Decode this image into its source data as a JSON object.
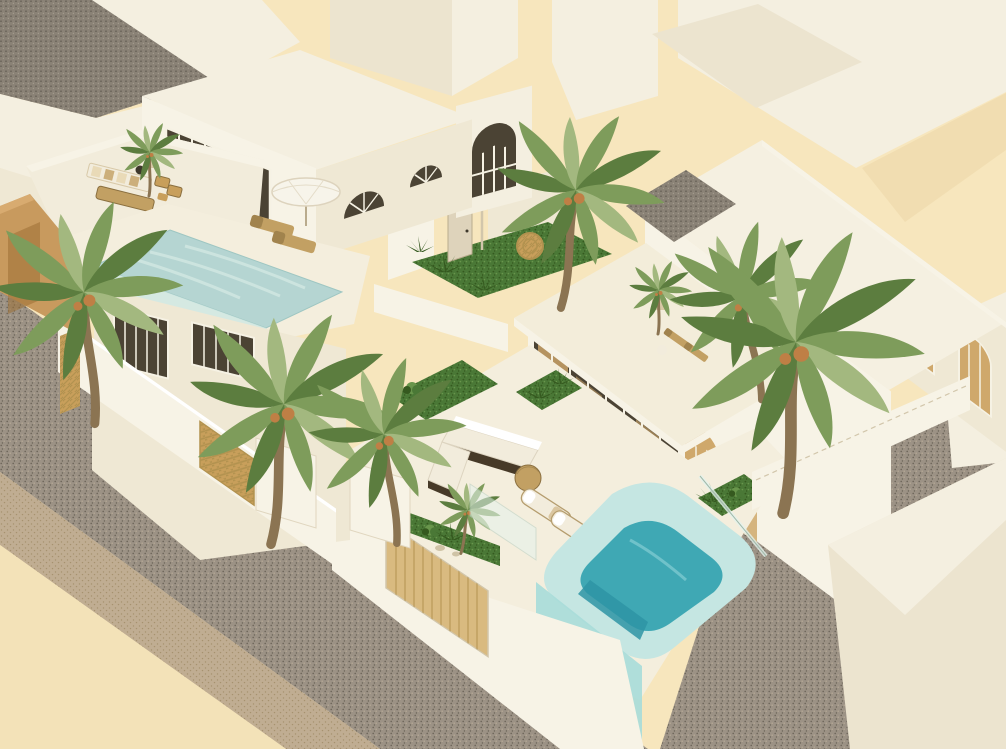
{
  "scene": {
    "title": "Aerial 3D architectural rendering of two white Mediterranean villas with pools, palm trees and sandy streets",
    "view": "isometric aerial visualization, warm cream daylight palette",
    "objects": {
      "background": "flat warm-cream ground with untextured white massing blocks of neighboring buildings",
      "neighbor_building": "white building top-left with dark speckled gray flat roof and arched loggia openings",
      "left_villa": "three-level white villa with arched mullioned window walls, fan-light arched windows, upper sofa terrace, rooftop infinity pool with glass edge, two tan loungers and a white round umbrella",
      "left_villa_terrace": "striped beige sofa, tan daybed, two rattan chairs, dark round pot, small potted palm",
      "right_villa": "long white villa with four arched warm-lit windows on the street side, arched glass door walls, one-story wing with roof terrace, rattan chairs and potted palm",
      "right_villa_courtyard": "white L-shaped sofa on dark wicker base, round tan pouf, two white cushioned loungers, grass beds, turquoise plunge pool with pale rim, glass fence and street-side glass overflow wall",
      "street_wall": "white perimeter walls with light wood garage door, woven rattan pedestrian gate, planter strip with shrubs and stones, glass balustrade panels",
      "streets": "speckled gray-brown main road running diagonally lower-left with lighter tan sidewalk and cream ground corner; second side street lower-right",
      "bottom_right_building": "plain white massing block across the side street",
      "ochre_wall": "warm ochre arched wall fragment at far left edge",
      "palm_trees": "nine palms of varying size, several with orange date clusters, plus agave tufts and shrubs in beds and planters"
    },
    "counts": {
      "villas": 2,
      "pools": 2,
      "large_palms": 6,
      "small_palms": 3,
      "arched_street_windows": 4,
      "tan_loungers": 2,
      "white_loungers": 2
    }
  },
  "colors": {
    "background": "#f7e6bd",
    "shadow_warm": "#eed9ab",
    "block_light": "#f4efe0",
    "block_face": "#ece4cf",
    "block_shade": "#e0d6bf",
    "block_deep": "#d2c6ab",
    "white_wall": "#f7f3e6",
    "wall_cream": "#efe8d4",
    "floor_light": "#f4eedd",
    "terrace_floor": "#f2ecdb",
    "roof_gray": "#8a8276",
    "roof_gray_dot": "#5a544a",
    "road_base": "#9c9285",
    "road_dot": "#6b6458",
    "road_light": "#b3a794",
    "sidewalk": "#c0ad92",
    "sidewalk_dot": "#a6926f",
    "ground": "#f3e2b8",
    "ochre": "#c89a5e",
    "ochre_dark": "#9c7034",
    "ochre_light": "#d8ab70",
    "pool_top": "#b5d5d2",
    "pool_top_light": "#d6e9e4",
    "pool_glass": "#cfe8e3",
    "pool_rim": "#c5e6e2",
    "pool_water": "#3fa8b4",
    "pool_water_deep": "#2e94a4",
    "pool_face": "#a8dcd9",
    "grass": "#4a7836",
    "grass_dark": "#35591f",
    "grass_light": "#68954b",
    "palm_green": "#7e9c5b",
    "palm_dark": "#5c7d3f",
    "palm_light": "#a3b87f",
    "dates_orange": "#bf7f45",
    "trunk": "#8b7452",
    "wood": "#d9ba80",
    "wood_line": "#b2924f",
    "rattan": "#c89f5b",
    "furn_tan": "#c2a063",
    "furn_dark": "#8a6f3f",
    "wicker_dark": "#473a28",
    "cushion": "#f2ecdc",
    "stripe": "#e6d6ae",
    "glass_dark": "#4b4334",
    "interior_warm": "#cfa86b",
    "mullion": "#f6f2e4",
    "door_cream": "#ded3bb",
    "umbrella": "#f7f4ea",
    "pot_dark": "#3e382c",
    "pot_cream": "#d8c8a6",
    "fence_glass": "#e4f2ec"
  }
}
